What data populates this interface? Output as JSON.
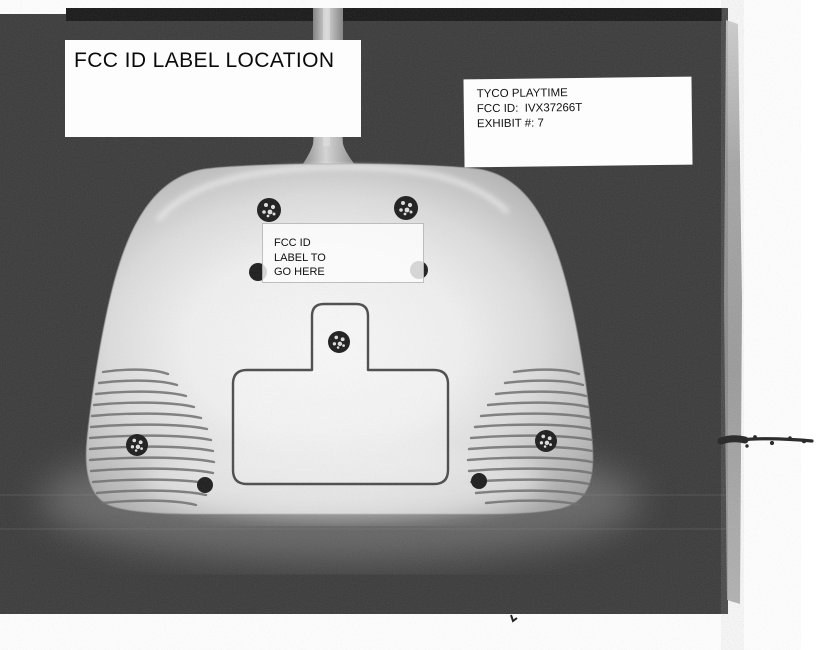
{
  "title_box": {
    "text": "FCC ID LABEL LOCATION"
  },
  "exhibit_box": {
    "line1": "TYCO PLAYTIME",
    "line2": "FCC ID:  IVX37266T",
    "line3": "EXHIBIT #: 7"
  },
  "device_label": {
    "line1": "FCC ID",
    "line2": "LABEL TO",
    "line3": "GO HERE"
  },
  "colors": {
    "paper": "#ffffff",
    "photo_background": "#3a3a3a",
    "device_body_highlight": "#f6f6f6",
    "device_body_shadow": "#7a7a7a"
  }
}
